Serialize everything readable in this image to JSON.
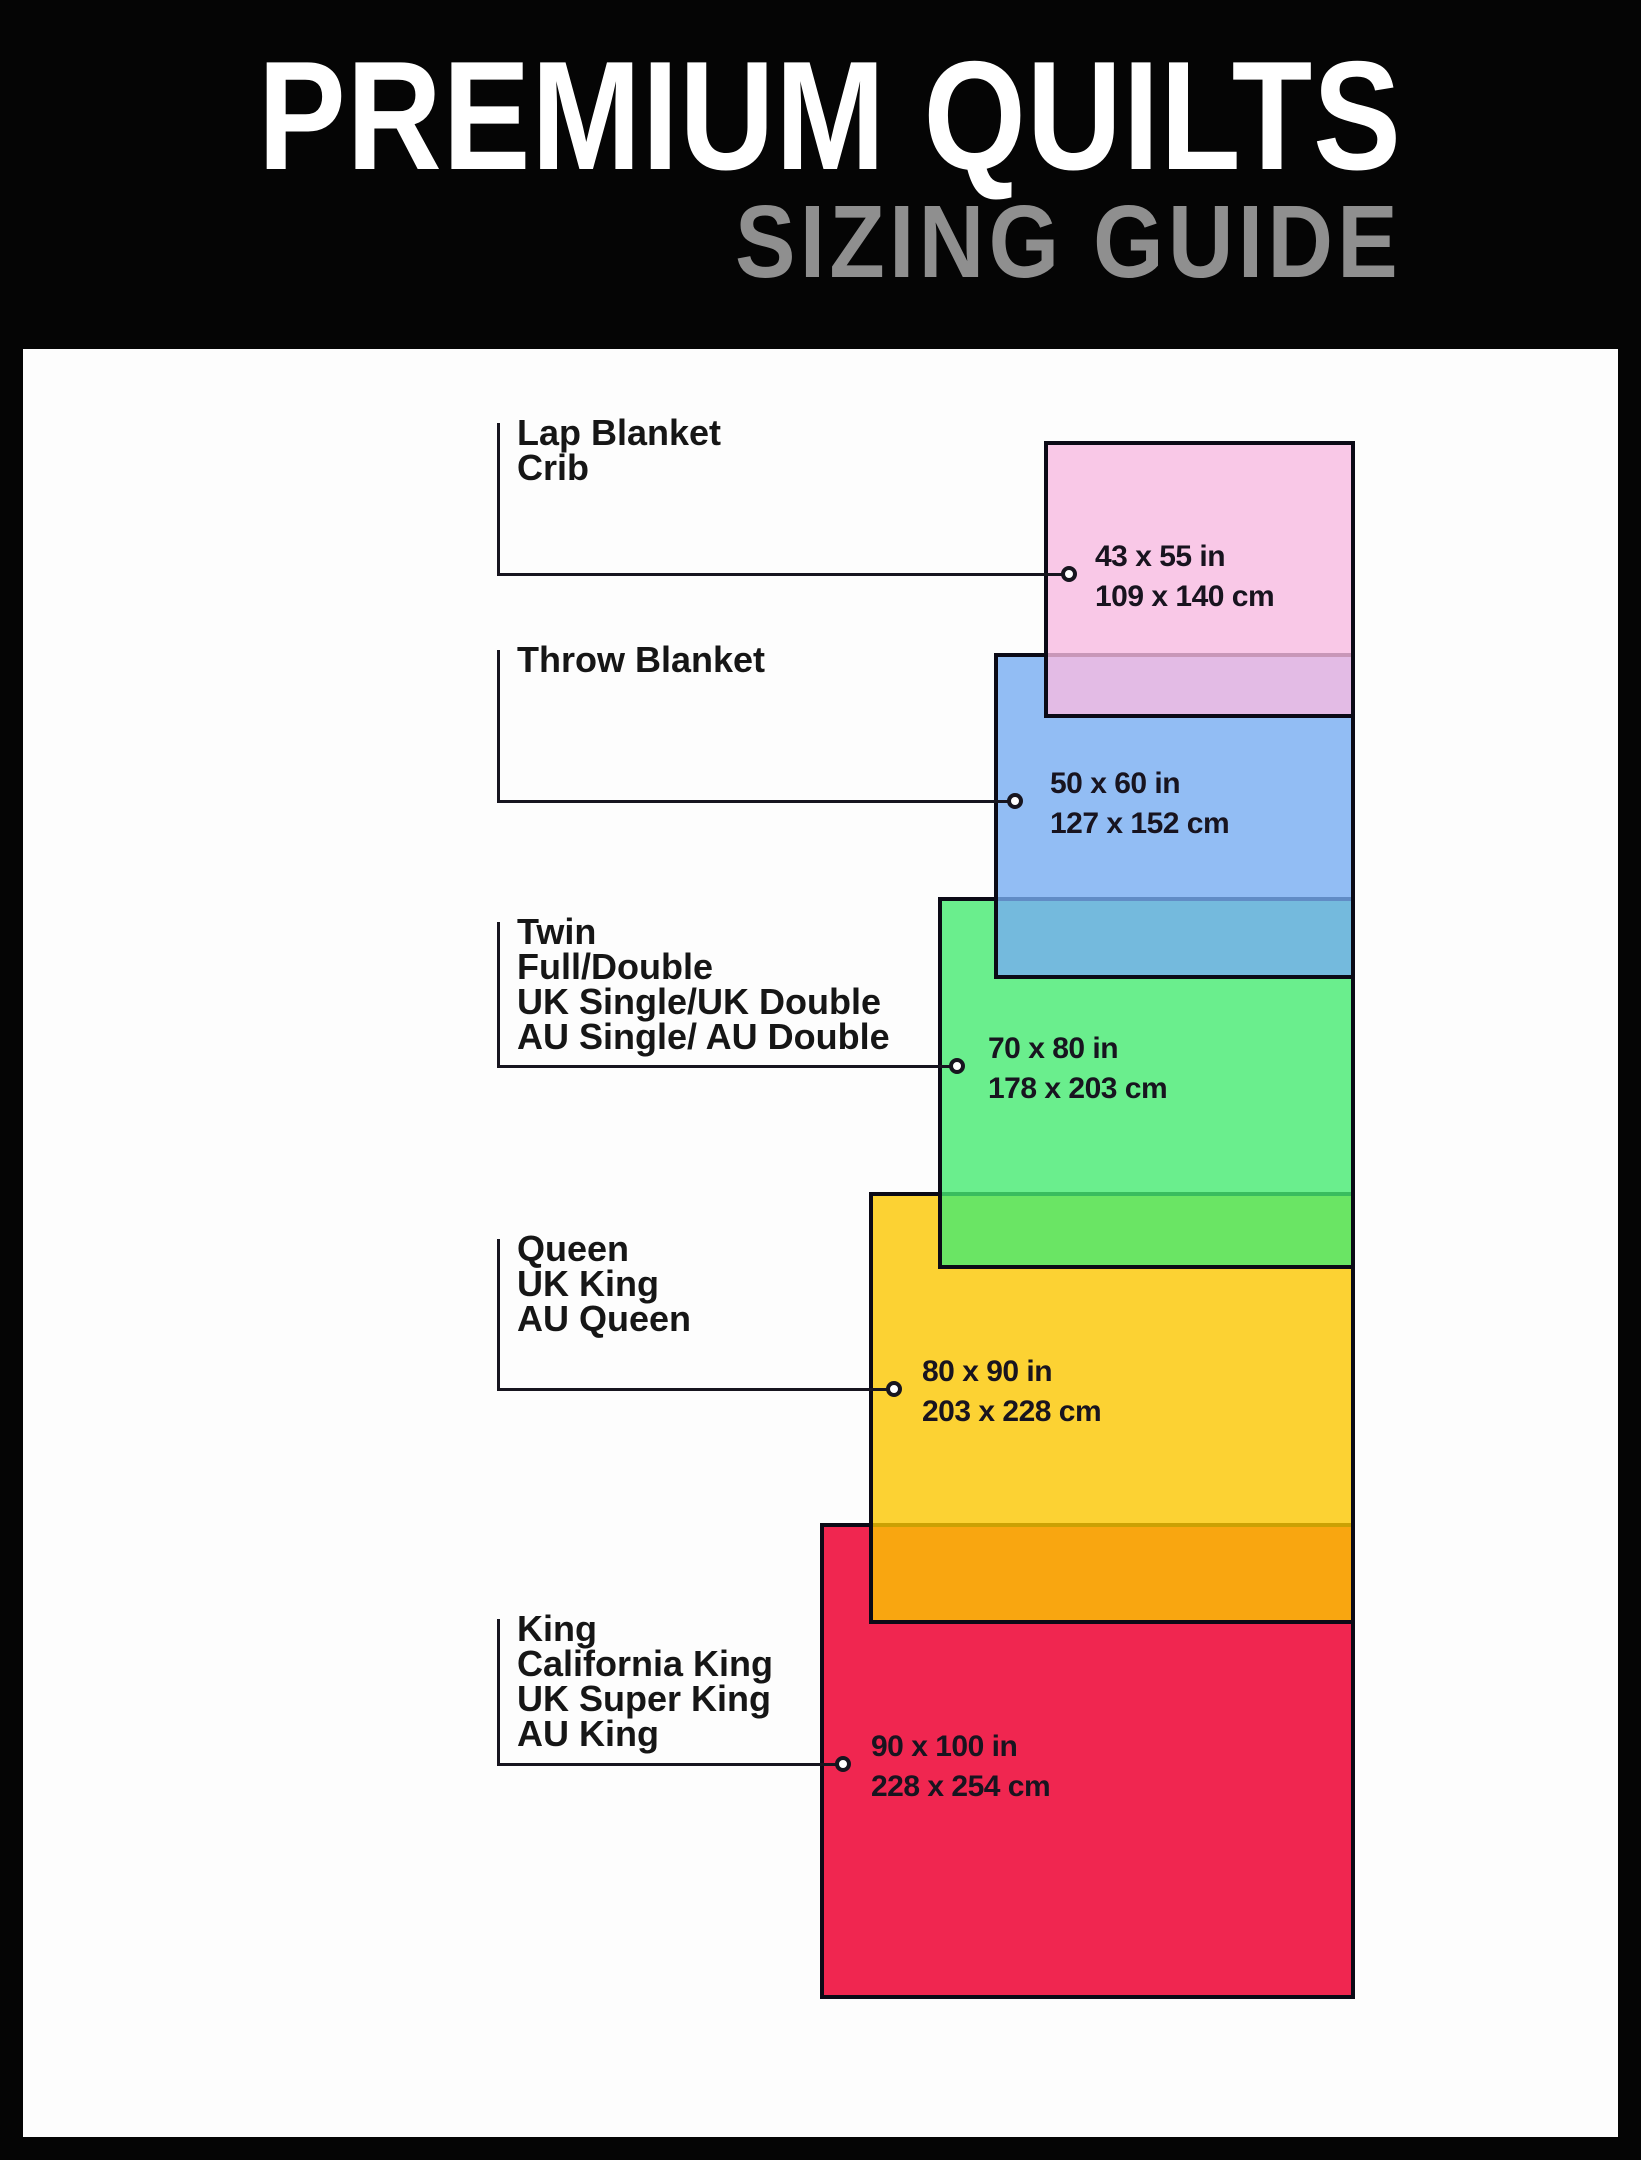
{
  "header": {
    "title": "PREMIUM QUILTS",
    "subtitle": "SIZING GUIDE"
  },
  "palette": {
    "background": "#050505",
    "panel": "#fdfdfd",
    "title_color": "#ffffff",
    "subtitle_color": "#8f8f8f",
    "rect_border": "#0b0a16",
    "callout_line": "#17151f",
    "label_text": "#161616",
    "dimension_text": "#18141f"
  },
  "diagram": {
    "sizes": [
      {
        "name": "lap-blanket-crib",
        "label_lines": [
          "Lap Blanket",
          "Crib"
        ],
        "size_in": "43 x 55 in",
        "size_cm": "109 x 140 cm",
        "fill": "rgba(248,186,225,0.8)",
        "rect": {
          "x": 1044,
          "y": 441,
          "w": 311,
          "h": 277
        },
        "label_top": 415,
        "connector_y": 574,
        "dot_x": 1069,
        "text_x": 1095
      },
      {
        "name": "throw-blanket",
        "label_lines": [
          "Throw Blanket"
        ],
        "size_in": "50 x 60 in",
        "size_cm": "127 x 152 cm",
        "fill": "rgba(119,173,241,0.8)",
        "rect": {
          "x": 994,
          "y": 653,
          "w": 361,
          "h": 326
        },
        "label_top": 642,
        "connector_y": 801,
        "dot_x": 1015,
        "text_x": 1050
      },
      {
        "name": "twin-full-double",
        "label_lines": [
          "Twin",
          "Full/Double",
          "UK Single/UK Double",
          "AU Single/ AU Double"
        ],
        "size_in": "70 x 80 in",
        "size_cm": "178 x 203 cm",
        "fill": "rgba(69,234,113,0.8)",
        "rect": {
          "x": 938,
          "y": 897,
          "w": 417,
          "h": 372
        },
        "label_top": 914,
        "connector_y": 1066,
        "dot_x": 957,
        "text_x": 988
      },
      {
        "name": "queen-uk-king-au-queen",
        "label_lines": [
          "Queen",
          "UK King",
          "AU Queen"
        ],
        "size_in": "80 x 90 in",
        "size_cm": "203 x 228 cm",
        "fill": "rgba(251,199,0,0.8)",
        "rect": {
          "x": 869,
          "y": 1192,
          "w": 486,
          "h": 432
        },
        "label_top": 1231,
        "connector_y": 1389,
        "dot_x": 894,
        "text_x": 922
      },
      {
        "name": "king-california-king",
        "label_lines": [
          "King",
          "California King",
          "UK Super King",
          "AU King"
        ],
        "size_in": "90 x 100 in",
        "size_cm": "228 x 254 cm",
        "fill": "rgba(237,0,49,0.85)",
        "rect": {
          "x": 820,
          "y": 1523,
          "w": 535,
          "h": 476
        },
        "label_top": 1611,
        "connector_y": 1764,
        "dot_x": 843,
        "text_x": 871
      }
    ]
  }
}
